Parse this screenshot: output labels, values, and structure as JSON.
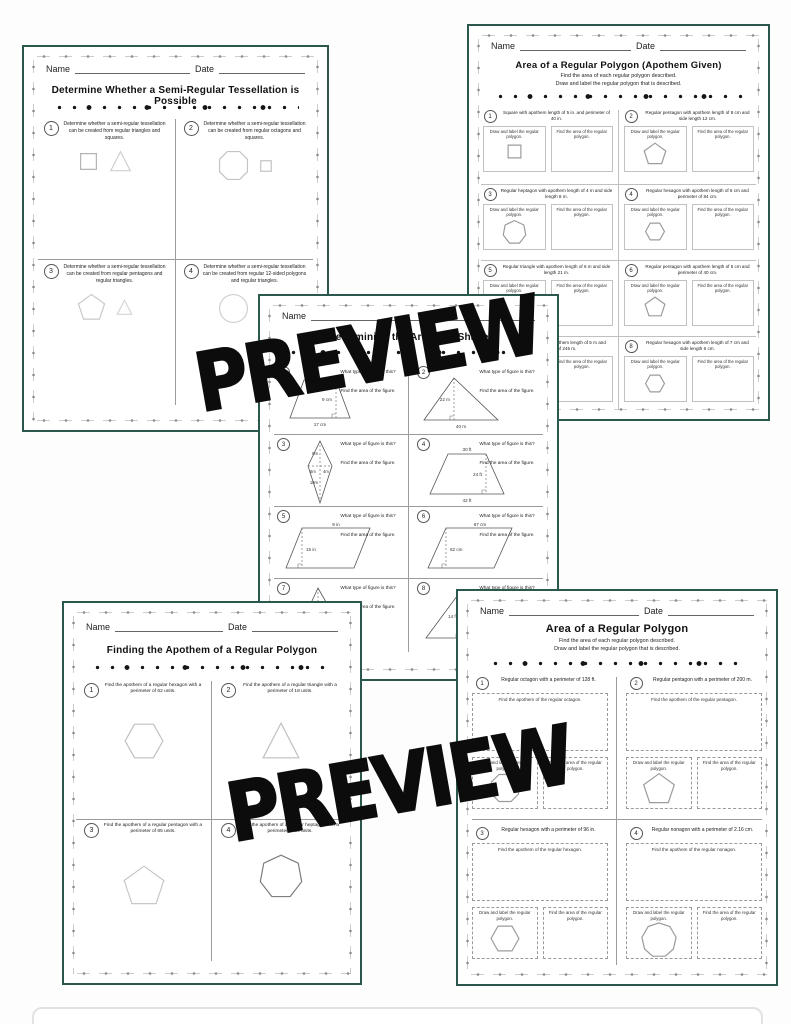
{
  "labels": {
    "name": "Name",
    "date": "Date"
  },
  "watermark": "PREVIEW",
  "colors": {
    "page_border": "#2b584d",
    "shape_stroke": "#bdbdbd",
    "figure_stroke": "#555555"
  },
  "tess": {
    "title": "Determine Whether a Semi-Regular Tessellation is Possible",
    "questions": [
      {
        "num": "1",
        "text": "Determine whether a semi-regular tessellation can be created from regular triangles and squares."
      },
      {
        "num": "2",
        "text": "Determine whether a semi-regular tessellation can be created from regular octagons and squares."
      },
      {
        "num": "3",
        "text": "Determine whether a semi-regular tessellation can be created from regular pentagons and regular triangles."
      },
      {
        "num": "4",
        "text": "Determine whether a semi-regular tessellation can be created from regular 12-sided polygons and regular triangles."
      }
    ]
  },
  "apothem_given": {
    "title": "Area of a Regular Polygon (Apothem Given)",
    "subtitle1": "Find the area of each regular polygon described.",
    "subtitle2": "Draw and label the regular polygon that is described.",
    "draw_label": "Draw and label the regular polygon.",
    "find_label": "Find the area of the regular polygon.",
    "questions": [
      {
        "num": "1",
        "text": "Square with apothem length of 5 in. and perimeter of 40 in."
      },
      {
        "num": "2",
        "text": "Regular pentagon with apothem length of 8 cm and side length 12 cm."
      },
      {
        "num": "3",
        "text": "Regular heptagon with apothem length of 4 m and side length 8 m."
      },
      {
        "num": "4",
        "text": "Regular hexagon with apothem length of 6 cm and perimeter of 84 cm."
      },
      {
        "num": "5",
        "text": "Regular triangle with apothem length of 6 m and side length 21 m."
      },
      {
        "num": "6",
        "text": "Regular pentagon with apothem length of 5 cm and perimeter of 40 cm."
      },
      {
        "num": "7",
        "text": "Regular polygon with apothem length of 5 m and perimeter of 245 m."
      },
      {
        "num": "8",
        "text": "Regular hexagon with apothem length of 7 cm and side length 6 cm."
      }
    ]
  },
  "area_shape": {
    "title": "Determining the Area of a Shape",
    "type_label": "What type of figure is this?",
    "find_label": "Find the area of the figure.",
    "questions": [
      {
        "num": "1",
        "labels": {
          "height": "9 cm",
          "base": "17 cm"
        }
      },
      {
        "num": "2",
        "labels": {
          "height": "22 m",
          "base": "40 m"
        }
      },
      {
        "num": "3",
        "labels": {
          "top": "6m",
          "left": "6m",
          "right": "4m",
          "bottom": "10m"
        }
      },
      {
        "num": "4",
        "labels": {
          "top": "30 ft",
          "height": "24 ft",
          "base": "42 ft"
        }
      },
      {
        "num": "5",
        "labels": {
          "top": "9 in",
          "side": "15 in"
        }
      },
      {
        "num": "6",
        "labels": {
          "top": "67 cm",
          "height": "62 cm"
        }
      },
      {
        "num": "7",
        "labels": {
          "height": "8 m"
        }
      },
      {
        "num": "8",
        "labels": {
          "height": "14 ft",
          "base": "52 ft"
        }
      }
    ]
  },
  "find_apothem": {
    "title": "Finding the Apothem of a Regular Polygon",
    "questions": [
      {
        "num": "1",
        "text": "Find the apothem of a regular hexagon with a perimeter of 62 units."
      },
      {
        "num": "2",
        "text": "Find the apothem of a regular triangle with a perimeter of 18 units."
      },
      {
        "num": "3",
        "text": "Find the apothem of a regular pentagon with a perimeter of 85 units."
      },
      {
        "num": "4",
        "text": "Find the apothem of a regular heptagon with a perimeter of 84 units."
      }
    ]
  },
  "area_regular": {
    "title": "Area of a Regular Polygon",
    "subtitle1": "Find the area of each regular polygon described.",
    "subtitle2": "Draw and label the regular polygon that is described.",
    "draw_label": "Draw and label the regular polygon.",
    "find_area_label": "Find the area of the regular polygon.",
    "questions": [
      {
        "num": "1",
        "text": "Regular octagon with a perimeter of 128 ft.",
        "apothem_label": "Find the apothem of the regular octagon."
      },
      {
        "num": "2",
        "text": "Regular pentagon with a perimeter of 200 m.",
        "apothem_label": "Find the apothem of the regular pentagon."
      },
      {
        "num": "3",
        "text": "Regular hexagon with a perimeter of 96 in.",
        "apothem_label": "Find the apothem of the regular hexagon."
      },
      {
        "num": "4",
        "text": "Regular nonagon with a perimeter of 2.16 cm.",
        "apothem_label": "Find the apothem of the regular nonagon."
      }
    ]
  }
}
